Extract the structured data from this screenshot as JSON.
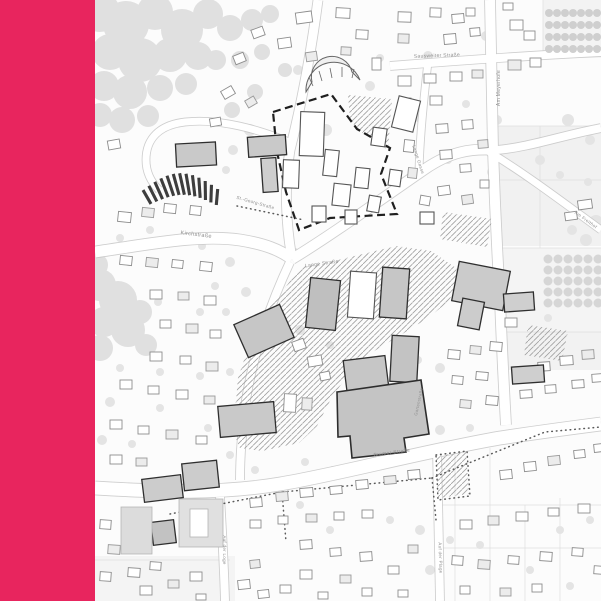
{
  "accent_panel": {
    "color": "#E8255E"
  },
  "map": {
    "background_color": "#FCFCFC",
    "colors": {
      "key_building_fill": "#C6C6C6",
      "building_outline": "#2F2F2F",
      "tree_fill": "#E0E0E0",
      "hatch_line": "#A0A0A0",
      "boundary_dash": "#1F1F1F",
      "road_casing": "#C6C6C6",
      "label_text": "#8F8F8F"
    },
    "street_labels": [
      {
        "id": "sausweiter-strasse",
        "text": "Sausweiter Straße",
        "x": 437,
        "y": 57,
        "rot": -2,
        "size": 5
      },
      {
        "id": "am-meyerhofe",
        "text": "Am Meyerhofe",
        "x": 500,
        "y": 88,
        "rot": -90,
        "size": 5
      },
      {
        "id": "kirchstrasse",
        "text": "Kirchstraße",
        "x": 196,
        "y": 236,
        "rot": 7,
        "size": 5.5
      },
      {
        "id": "st-georg-strasse",
        "text": "St.-Georg-Straße",
        "x": 255,
        "y": 204,
        "rot": 16,
        "size": 4.5
      },
      {
        "id": "lange-strasse",
        "text": "Lange Straße",
        "x": 322,
        "y": 265,
        "rot": -8,
        "size": 5
      },
      {
        "id": "lange-gasse",
        "text": "Lange Gasse",
        "x": 417,
        "y": 160,
        "rot": 72,
        "size": 4.5
      },
      {
        "id": "bremer-strasse",
        "text": "Bremer Straße",
        "x": 392,
        "y": 454,
        "rot": -8,
        "size": 5
      },
      {
        "id": "auf-der-loge",
        "text": "Auf der Loge",
        "x": 223,
        "y": 550,
        "rot": 90,
        "size": 4.5
      },
      {
        "id": "auf-der-plage",
        "text": "Auf der Plage",
        "x": 439,
        "y": 558,
        "rot": 88,
        "size": 4.5
      },
      {
        "id": "am-freithof",
        "text": "Am Freithof",
        "x": 585,
        "y": 221,
        "rot": 36,
        "size": 4.5
      },
      {
        "id": "gartenstrasse",
        "text": "Gartenstraße",
        "x": 420,
        "y": 402,
        "rot": -78,
        "size": 4.2
      }
    ]
  }
}
